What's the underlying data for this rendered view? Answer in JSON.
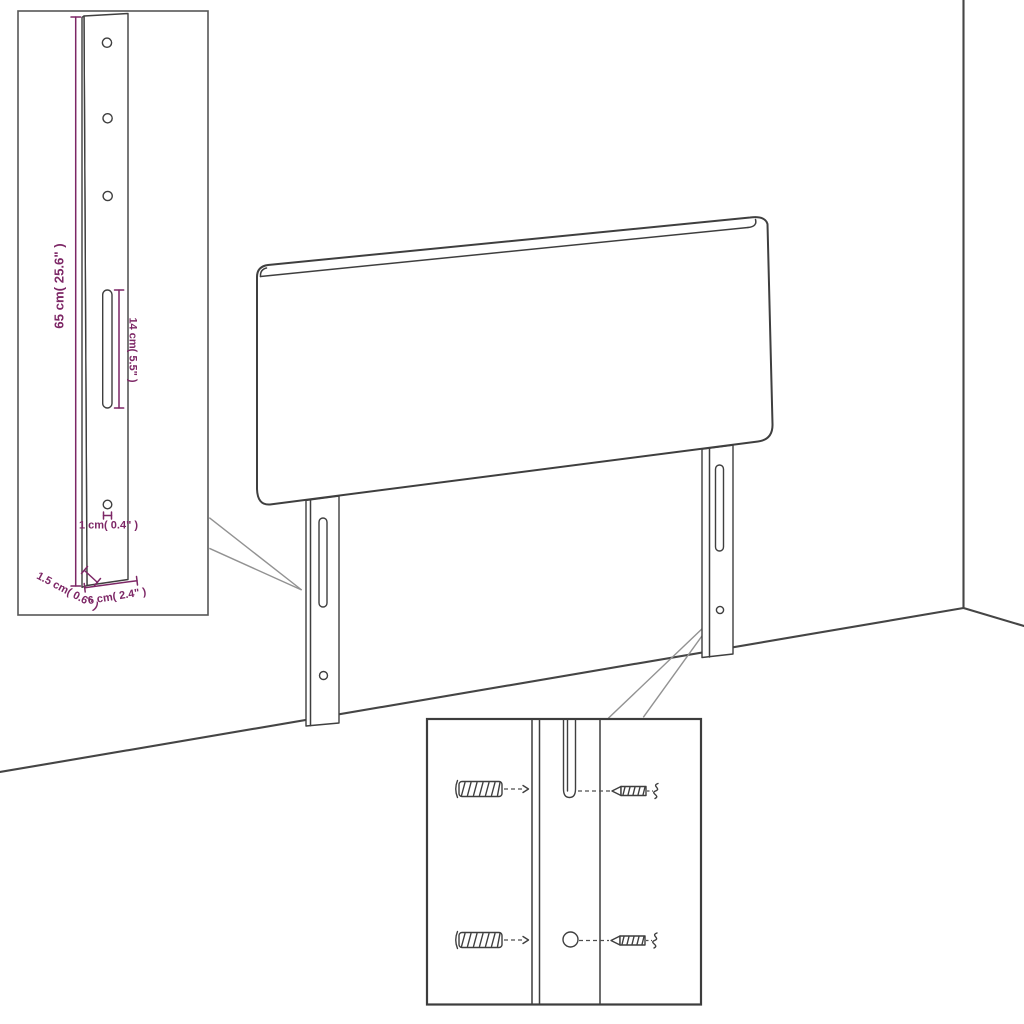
{
  "page": {
    "type": "product-assembly-diagram",
    "product": "headboard-with-mounting-legs",
    "background": "#ffffff"
  },
  "colors": {
    "outline": "#3f3f3f",
    "room_line": "#454545",
    "callout_line": "#929292",
    "dimension_accent": "#7d2766"
  },
  "leg_detail_inset": {
    "labels": {
      "leg_height": "65 cm( 25.6\" )",
      "slot_length": "14 cm( 5.5\" )",
      "hole_size": "1 cm( 0.4\" )",
      "leg_depth": "1.5 cm( 0.6\" )",
      "leg_width": "6 cm( 2.4\" )"
    }
  },
  "mounting_detail_inset": {
    "hardware": [
      "wall-plug",
      "wall-plug",
      "screw",
      "screw"
    ]
  }
}
